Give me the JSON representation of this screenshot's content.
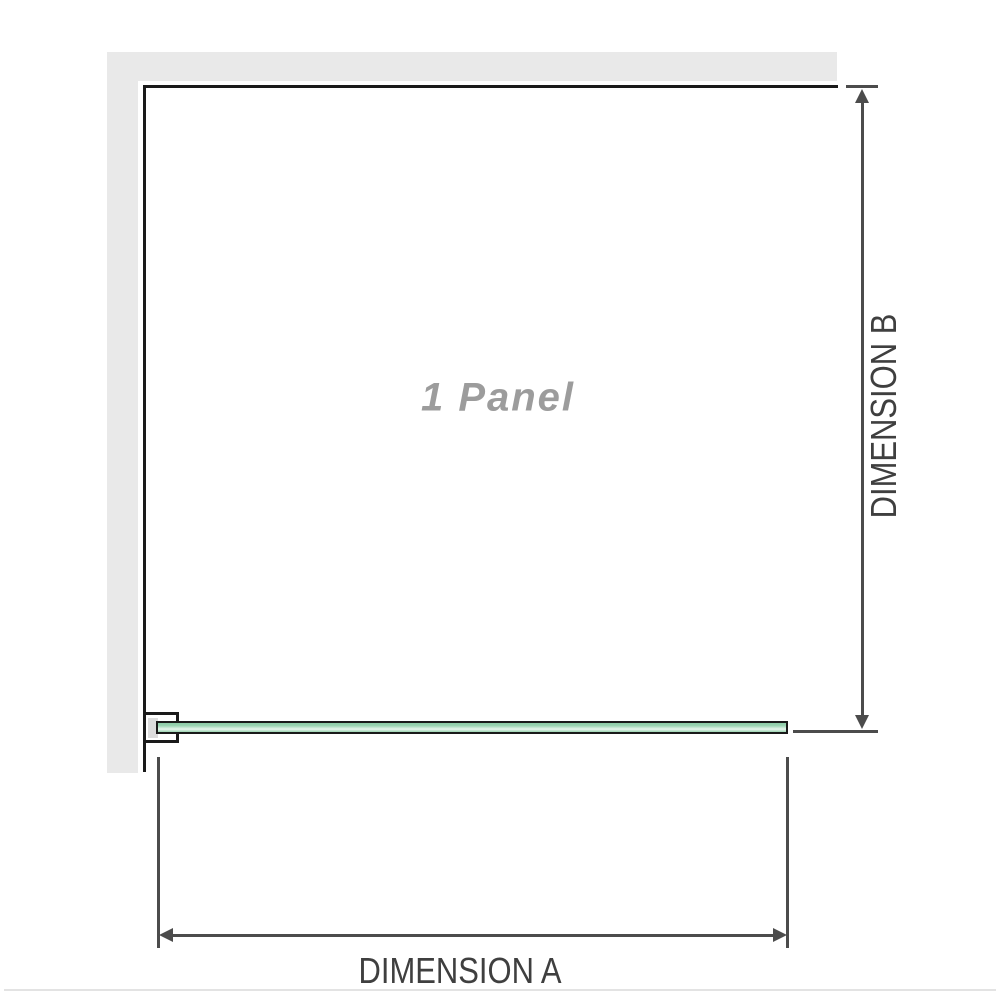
{
  "diagram": {
    "panel_label": "1 Panel",
    "dimension_a_label": "DIMENSION A",
    "dimension_b_label": "DIMENSION B"
  },
  "colors": {
    "wall_gray": "#e9e9e9",
    "edge_black": "#1a1a1a",
    "dim_gray": "#4c4c4c",
    "label_gray": "#3f3f3f",
    "panel_text_gray": "#9c9c9c",
    "glass_green": "#9bd4b2",
    "glass_green_light": "#e9f7ee",
    "glass_green_dark": "#8ccba6",
    "bracket_pad_gray": "#dcdcdc",
    "divider_gray": "#e3e3e3"
  }
}
